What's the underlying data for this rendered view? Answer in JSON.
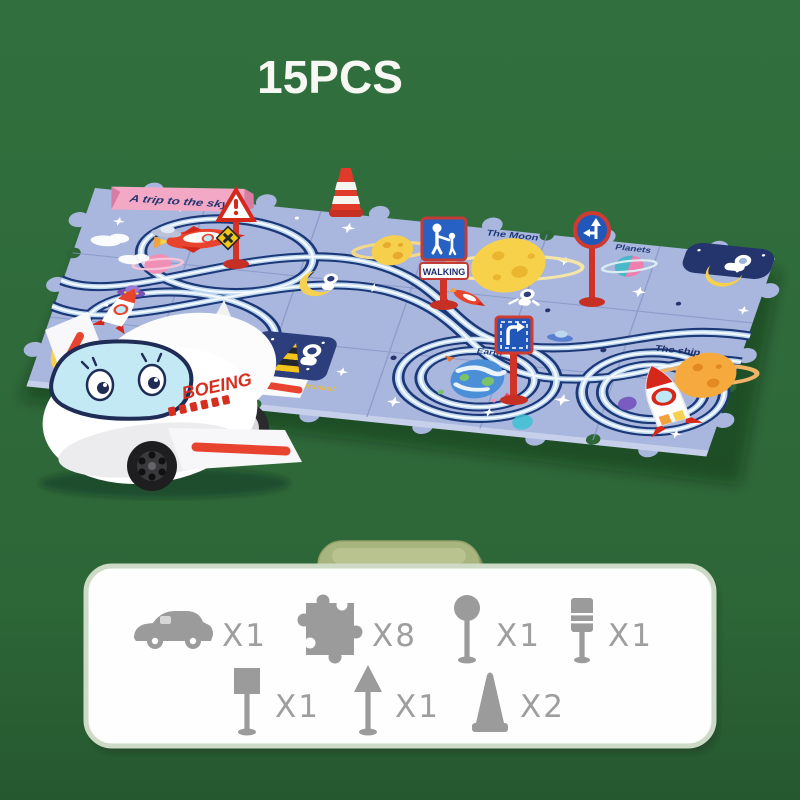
{
  "header": {
    "pieces_label": "15PCS"
  },
  "mat": {
    "banner_text": "A trip to the sky",
    "moon_label": "The Moon",
    "planets_label": "Planets",
    "earth_label": "Earth",
    "ship_label": "The ship",
    "astronaut_label": "Astronaut",
    "walking_sign_text": "WALKING"
  },
  "plane": {
    "brand_text": "BOEING"
  },
  "parts_panel": {
    "items": [
      {
        "icon": "car-icon",
        "count": "X1"
      },
      {
        "icon": "puzzle-piece-icon",
        "count": "X8"
      },
      {
        "icon": "round-sign-icon",
        "count": "X1"
      },
      {
        "icon": "traffic-light-icon",
        "count": "X1"
      },
      {
        "icon": "square-sign-icon",
        "count": "X1"
      },
      {
        "icon": "triangle-sign-icon",
        "count": "X1"
      },
      {
        "icon": "cone-icon",
        "count": "X2"
      }
    ]
  },
  "colors": {
    "background": "#2f6a3a",
    "mat_blue": "#a9b7de",
    "track_navy": "#1c3878",
    "panel_white": "#fdfefd",
    "panel_border": "#ccdac6",
    "pill_green": "#a9b57f",
    "icon_gray": "#9b9b9b",
    "sign_red": "#d23327",
    "sign_blue": "#2157b8",
    "brand_red": "#d62e1f",
    "banner_pink": "#f3a8c5"
  }
}
